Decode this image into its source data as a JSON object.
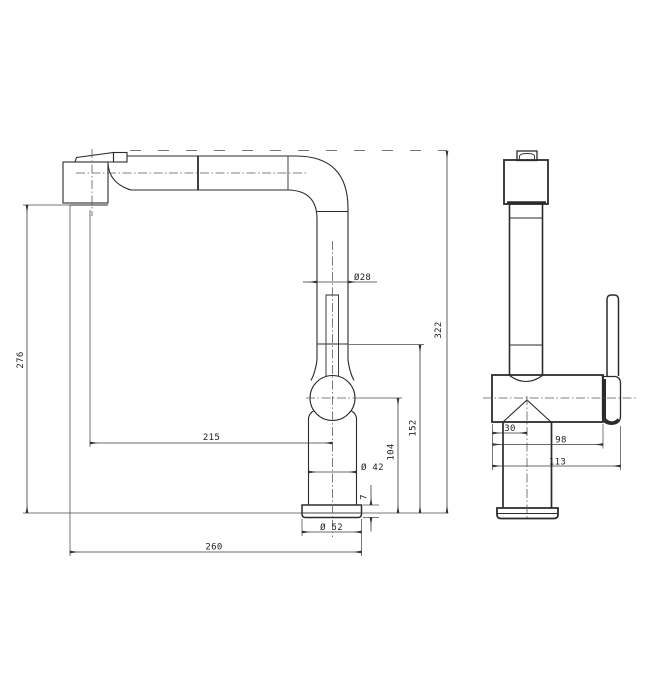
{
  "colors": {
    "background": "#ffffff",
    "line": "#2b2b2b"
  },
  "dims": {
    "height_overall": "322",
    "height_spout_outlet": "276",
    "spout_reach": "215",
    "width_overall": "260",
    "height_handle": "152",
    "height_body_center": "104",
    "spout_tube_dia": "Ø28",
    "body_dia": "Ø 42",
    "base_dia": "Ø 52",
    "base_thickness": "7",
    "body_front_offset": "30",
    "body_depth": "98",
    "depth_overall": "113"
  }
}
